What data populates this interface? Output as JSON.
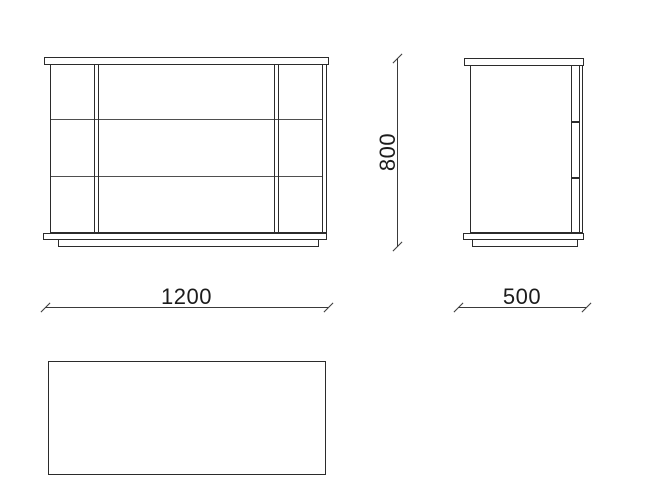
{
  "drawing": {
    "dimension_labels": {
      "width": "1200",
      "depth": "500",
      "height": "800"
    },
    "colors": {
      "background": "#ffffff",
      "outline": "#2b2b2b",
      "thin_line": "#4f4f4f",
      "dimension_line": "#3a3a3a",
      "text": "#1c1c1c"
    }
  }
}
